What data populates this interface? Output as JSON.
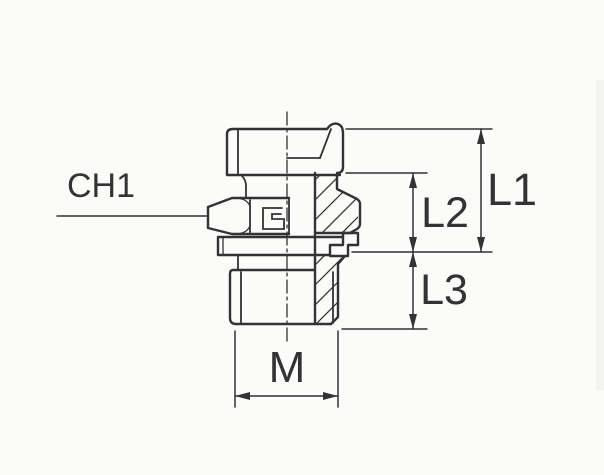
{
  "drawing": {
    "labels": {
      "ch1": "CH1",
      "l1": "L1",
      "l2": "L2",
      "l3": "L3",
      "m": "M"
    },
    "colors": {
      "line": "#333333",
      "background": "#fbfbf9",
      "seal_fill": "#3a3a3a",
      "arrow_fill": "#333333"
    }
  }
}
